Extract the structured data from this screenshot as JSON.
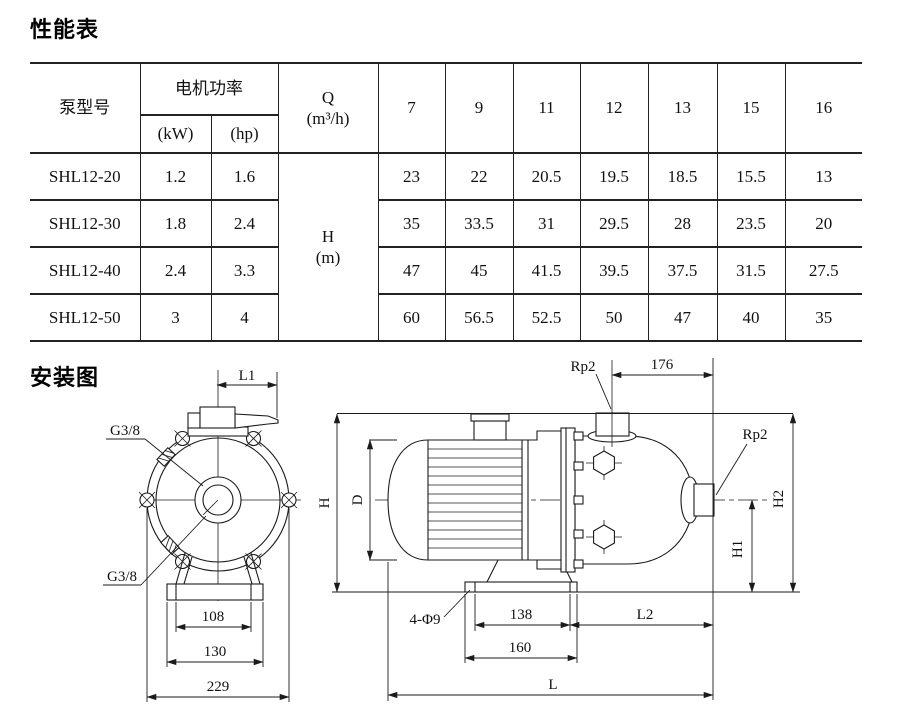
{
  "page": {
    "section1_title": "性能表",
    "section2_title": "安装图"
  },
  "table": {
    "header": {
      "model": "泵型号",
      "motor_power": "电机功率",
      "kw": "(kW)",
      "hp": "(hp)",
      "q_symbol": "Q",
      "q_unit": "(m³/h)",
      "flow_values": [
        "7",
        "9",
        "11",
        "12",
        "13",
        "15",
        "16"
      ],
      "head_symbol": "H",
      "head_unit": "(m)"
    },
    "rows": [
      {
        "model": "SHL12-20",
        "kw": "1.2",
        "hp": "1.6",
        "values": [
          "23",
          "22",
          "20.5",
          "19.5",
          "18.5",
          "15.5",
          "13"
        ]
      },
      {
        "model": "SHL12-30",
        "kw": "1.8",
        "hp": "2.4",
        "values": [
          "35",
          "33.5",
          "31",
          "29.5",
          "28",
          "23.5",
          "20"
        ]
      },
      {
        "model": "SHL12-40",
        "kw": "2.4",
        "hp": "3.3",
        "values": [
          "47",
          "45",
          "41.5",
          "39.5",
          "37.5",
          "31.5",
          "27.5"
        ]
      },
      {
        "model": "SHL12-50",
        "kw": "3",
        "hp": "4",
        "values": [
          "60",
          "56.5",
          "52.5",
          "50",
          "47",
          "40",
          "35"
        ]
      }
    ]
  },
  "diagram": {
    "front_view": {
      "l1": "L1",
      "g38_top": "G3/8",
      "g38_bottom": "G3/8",
      "dim_108": "108",
      "dim_130": "130",
      "dim_229": "229"
    },
    "side_view": {
      "rp2_top": "Rp2",
      "rp2_side": "Rp2",
      "dim_176": "176",
      "h": "H",
      "d": "D",
      "h2": "H2",
      "h1": "H1",
      "holes": "4-Φ9",
      "dim_138": "138",
      "l2": "L2",
      "dim_160": "160",
      "l": "L"
    }
  }
}
